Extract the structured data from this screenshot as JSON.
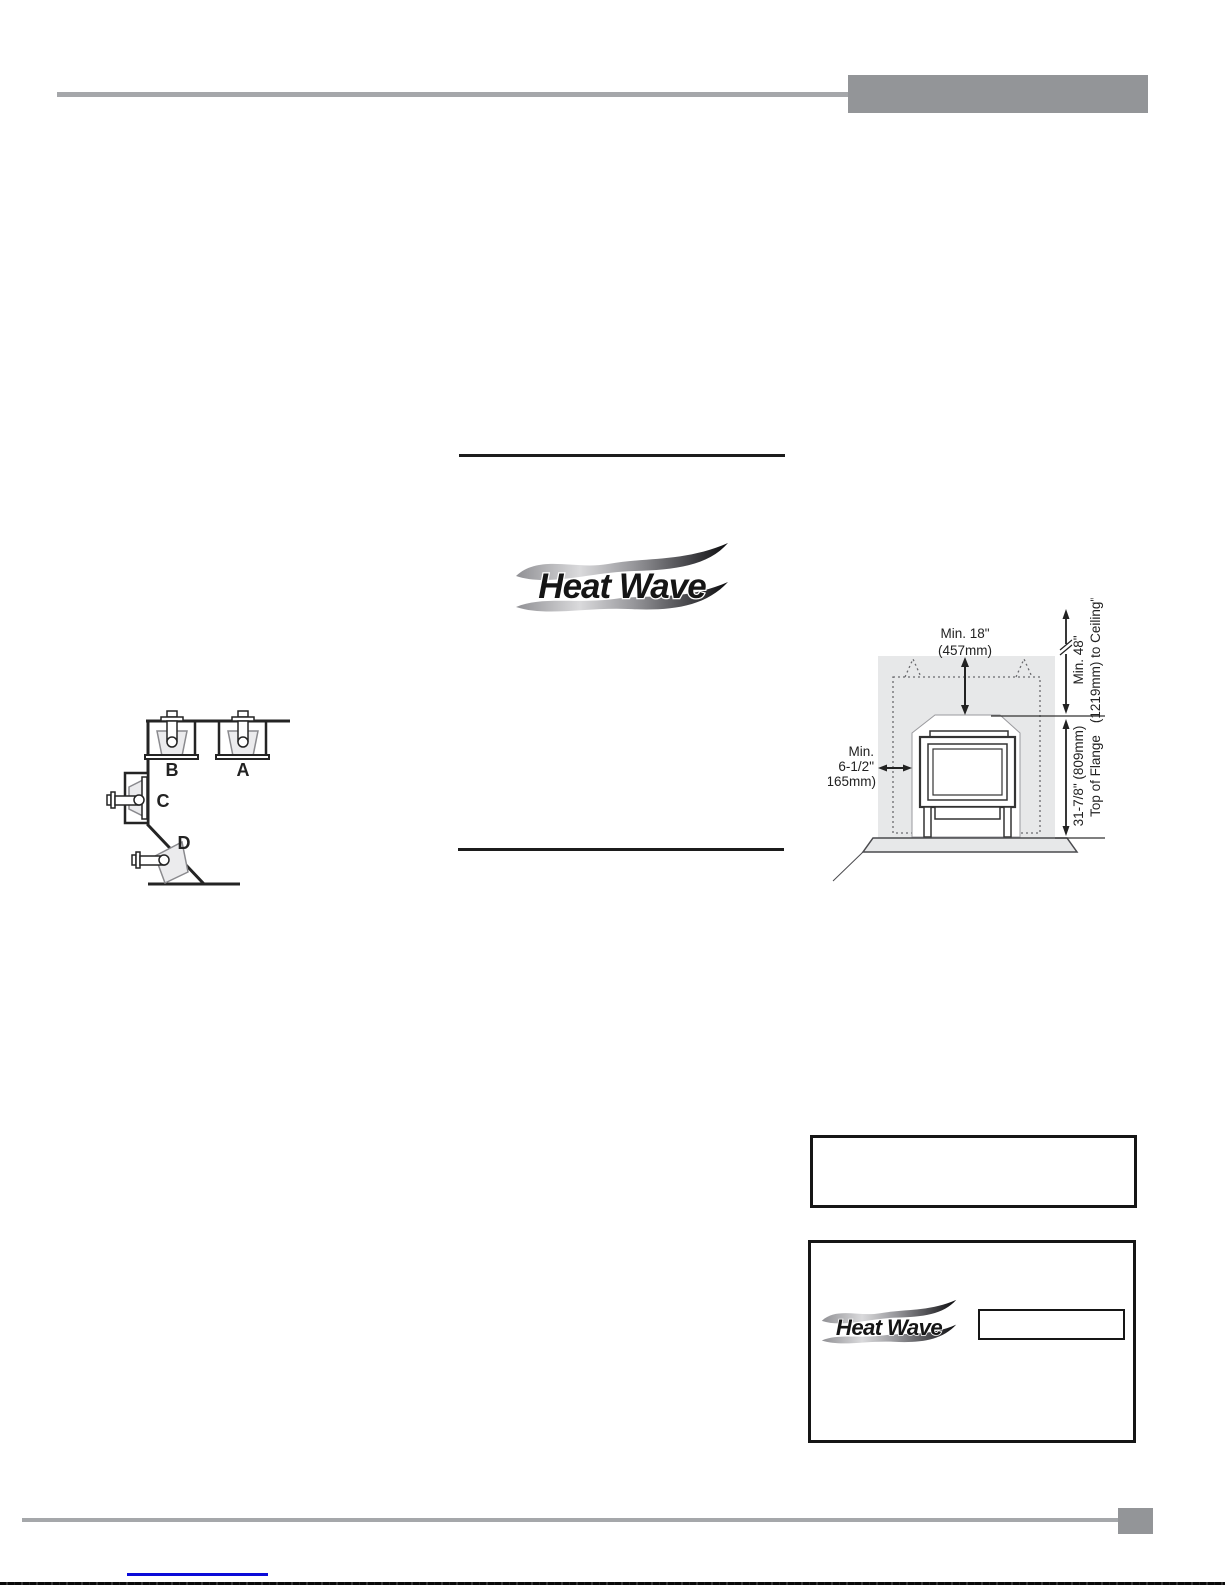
{
  "logo": {
    "text": "Heat Wave"
  },
  "mounting_diagram": {
    "label_a": "A",
    "label_b": "B",
    "label_c": "C",
    "label_d": "D"
  },
  "clearance_diagram": {
    "top_clearance": {
      "line1": "Min. 18\"",
      "line2": "(457mm)"
    },
    "side_clearance": {
      "line1": "Min.",
      "line2": "6-1/2\"",
      "line3": "(165mm)"
    },
    "ceiling_clearance": {
      "line1": "Min. 48\"",
      "line2": "(1219mm) to Ceiling\""
    },
    "flange_height": {
      "line1": "31-7/8\" (809mm)",
      "line2": "Top of Flange"
    }
  },
  "colors": {
    "header_gray": "#939598",
    "rule_gray": "#a5a7aa",
    "wall_gray": "#e7e8e9",
    "link_blue": "#0b0bd8"
  }
}
